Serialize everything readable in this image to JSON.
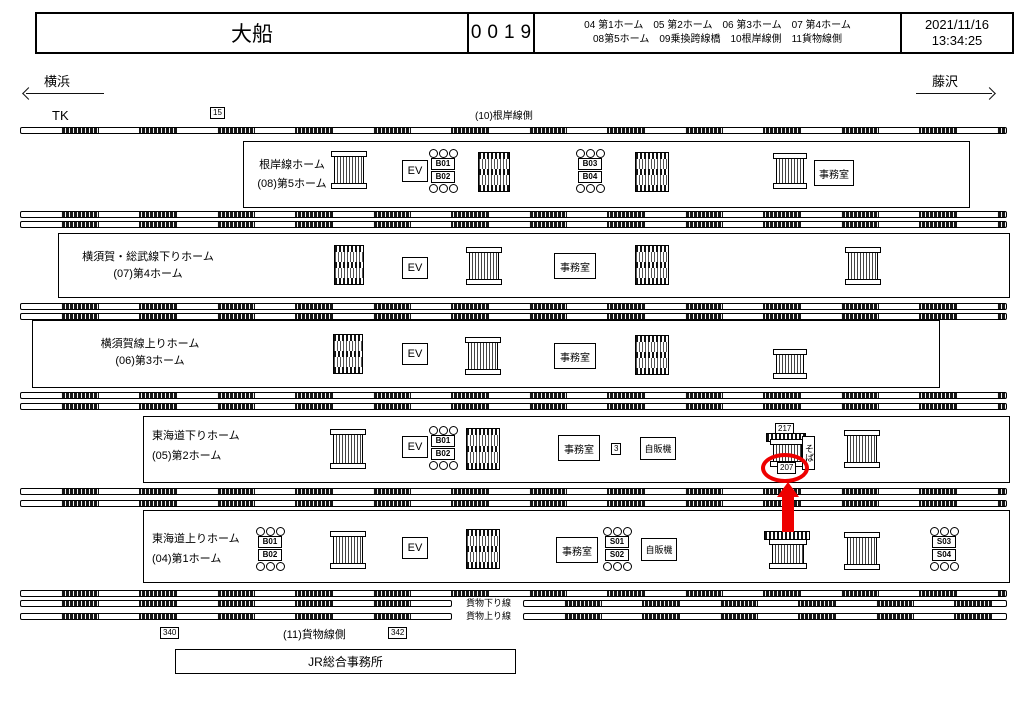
{
  "header": {
    "station": "大船",
    "code": "0019",
    "legend_line1": "04 第1ホーム　05 第2ホーム　06 第3ホーム　07 第4ホーム",
    "legend_line2": "08第5ホーム　09乗換跨線橋　10根岸線側　11貨物線側",
    "date": "2021/11/16",
    "time": "13:34:25"
  },
  "directions": {
    "left": "横浜",
    "right": "藤沢"
  },
  "top": {
    "tk": "TK",
    "marker15": "15",
    "negishi_side": "(10)根岸線側"
  },
  "platforms": [
    {
      "name": "根岸線ホーム",
      "number": "(08)第5ホーム"
    },
    {
      "name": "横須賀・総武線下りホーム",
      "number": "(07)第4ホーム"
    },
    {
      "name": "横須賀線上りホーム",
      "number": "(06)第3ホーム"
    },
    {
      "name": "東海道下りホーム",
      "number": "(05)第2ホーム"
    },
    {
      "name": "東海道上りホーム",
      "number": "(04)第1ホーム"
    }
  ],
  "labels": {
    "ev": "EV",
    "office": "事務室",
    "vending": "自販機",
    "soba": "そば"
  },
  "markers": {
    "b01": "B01",
    "b02": "B02",
    "b03": "B03",
    "b04": "B04",
    "s01": "S01",
    "s02": "S02",
    "s03": "S03",
    "s04": "S04",
    "m3": "3",
    "m217": "217",
    "m207": "207",
    "m340": "340",
    "m342": "342"
  },
  "bottom": {
    "freight_down": "貨物下り線",
    "freight_up": "貨物上り線",
    "freight_side": "(11)貨物線側",
    "jr_office": "JR総合事務所"
  },
  "highlight": {
    "color": "#ee0000",
    "circled_marker": "207"
  }
}
